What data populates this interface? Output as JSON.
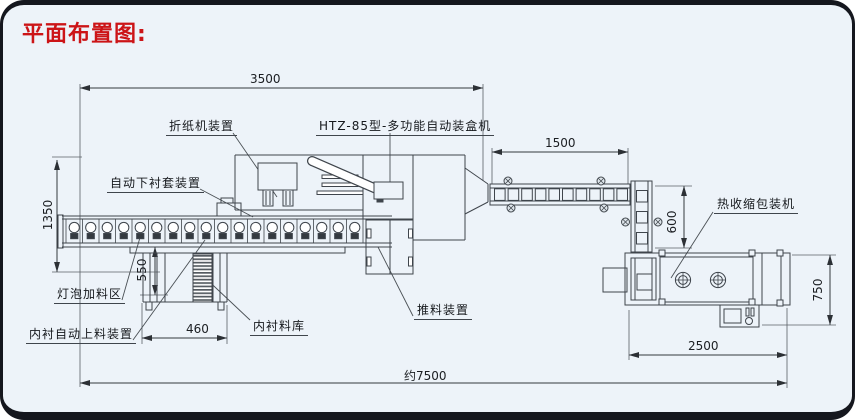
{
  "title": "平面布置图:",
  "colors": {
    "title_red": "#cc1417",
    "line": "#3f454c",
    "background": "#edf3f9",
    "border": "#15171e"
  },
  "labels": {
    "folding": "折纸机装置",
    "cartoner": "HTZ-85型-多功能自动装盒机",
    "liner_sleeve": "自动下衬套装置",
    "bulb_feed": "灯泡加料区",
    "liner_feeder": "内衬自动上料装置",
    "liner_storage": "内衬料库",
    "pusher": "推料装置",
    "shrink_wrapper": "热收缩包装机"
  },
  "dimensions": {
    "top_width": "3500",
    "belt_length": "1500",
    "left_height": "1350",
    "elevator_height": "550",
    "elevator_width": "460",
    "down_belt_height": "600",
    "wrapper_depth": "750",
    "wrapper_length": "2500",
    "total_length": "约7500"
  }
}
